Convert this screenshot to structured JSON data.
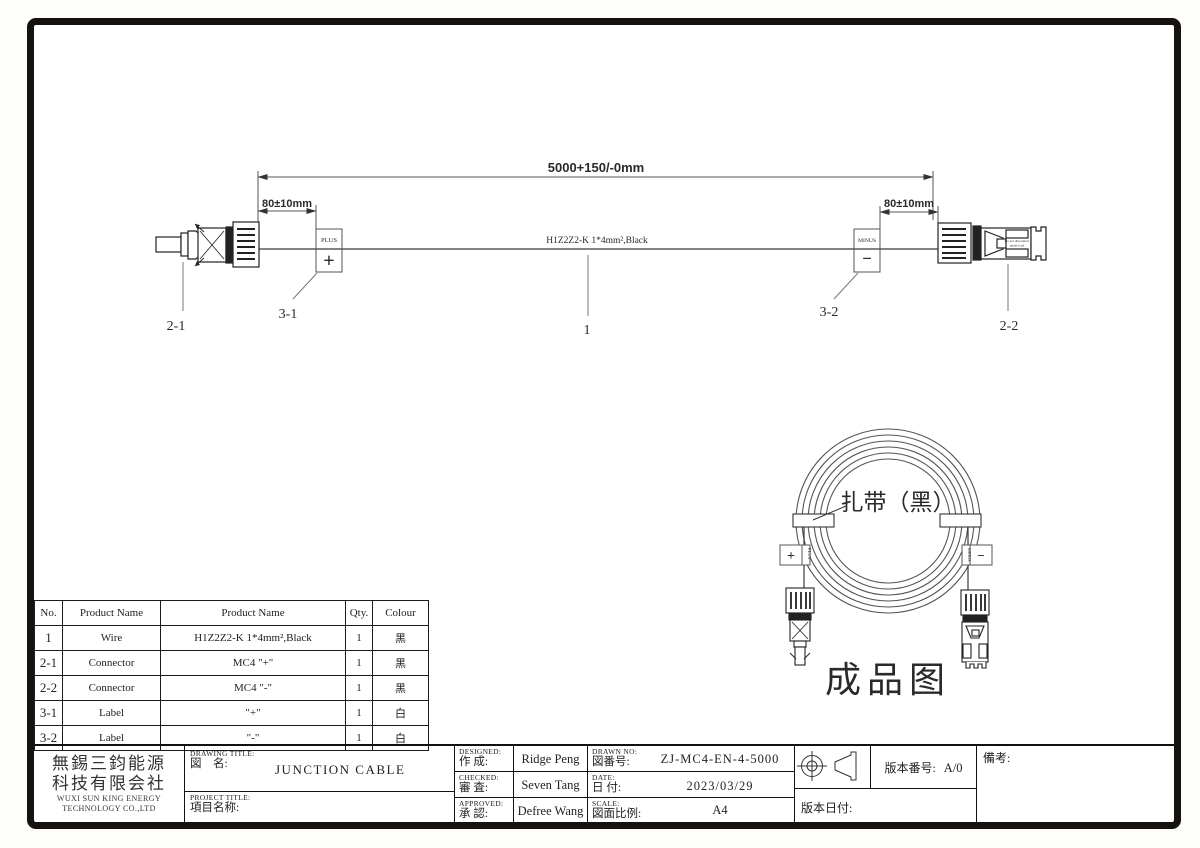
{
  "drawing": {
    "dim_total": "5000+150/-0mm",
    "dim_left": "80±10mm",
    "dim_right": "80±10mm",
    "cable_spec": "H1Z2Z2-K 1*4mm²,Black",
    "plus_tag": {
      "label": "PLUS",
      "symbol": "+"
    },
    "minus_tag": {
      "label": "MINUS",
      "symbol": "−"
    },
    "callouts": {
      "wire": "1",
      "connector_left": "2-1",
      "connector_right": "2-2",
      "label_left": "3-1",
      "label_right": "3-2"
    },
    "connector_marking_line1": "Do not disconnect",
    "connector_marking_line2": "under load"
  },
  "finished_view": {
    "tie_label": "扎带（黑）",
    "caption": "成品图",
    "plus_symbol": "+",
    "plus_text": "PLUS",
    "minus_symbol": "−",
    "minus_text": "MINUS"
  },
  "bom": {
    "headers": [
      "No.",
      "Product Name",
      "Product Name",
      "Qty.",
      "Colour"
    ],
    "rows": [
      {
        "no": "1",
        "name": "Wire",
        "spec": "H1Z2Z2-K 1*4mm²,Black",
        "qty": "1",
        "colour": "黑"
      },
      {
        "no": "2-1",
        "name": "Connector",
        "spec": "MC4  \"+\"",
        "qty": "1",
        "colour": "黑"
      },
      {
        "no": "2-2",
        "name": "Connector",
        "spec": "MC4  \"-\"",
        "qty": "1",
        "colour": "黑"
      },
      {
        "no": "3-1",
        "name": "Label",
        "spec": "\"+\"",
        "qty": "1",
        "colour": "白"
      },
      {
        "no": "3-2",
        "name": "Label",
        "spec": "\"-\"",
        "qty": "1",
        "colour": "白"
      }
    ]
  },
  "title_block": {
    "company_cn_line1": "無錫三鈞能源",
    "company_cn_line2": "科技有限会社",
    "company_en_line1": "WUXI SUN KING ENERGY",
    "company_en_line2": "TECHNOLOGY CO.,LTD",
    "drawing_title_label_en": "DRAWING TITLE:",
    "drawing_title_label_cn": "図　名:",
    "drawing_title_value": "JUNCTION CABLE",
    "project_title_label_en": "PROJECT TITLE:",
    "project_title_label_cn": "項目名称:",
    "designed_label_en": "DESIGNED:",
    "designed_label_cn": "作 成:",
    "designed_value": "Ridge Peng",
    "checked_label_en": "CHECKED:",
    "checked_label_cn": "審 査:",
    "checked_value": "Seven Tang",
    "approved_label_en": "APPROVED:",
    "approved_label_cn": "承 認:",
    "approved_value": "Defree Wang",
    "drawn_no_label_en": "DRAWN NO:",
    "drawn_no_label_cn": "図番号:",
    "drawn_no_value": "ZJ-MC4-EN-4-5000",
    "date_label_en": "DATE:",
    "date_label_cn": "日 付:",
    "date_value": "2023/03/29",
    "scale_label_en": "SCALE:",
    "scale_label_cn": "図面比例:",
    "scale_value": "A4",
    "version_label": "版本番号:",
    "version_value": "A/0",
    "version_date_label": "版本日付:",
    "remark_label": "備考:"
  }
}
